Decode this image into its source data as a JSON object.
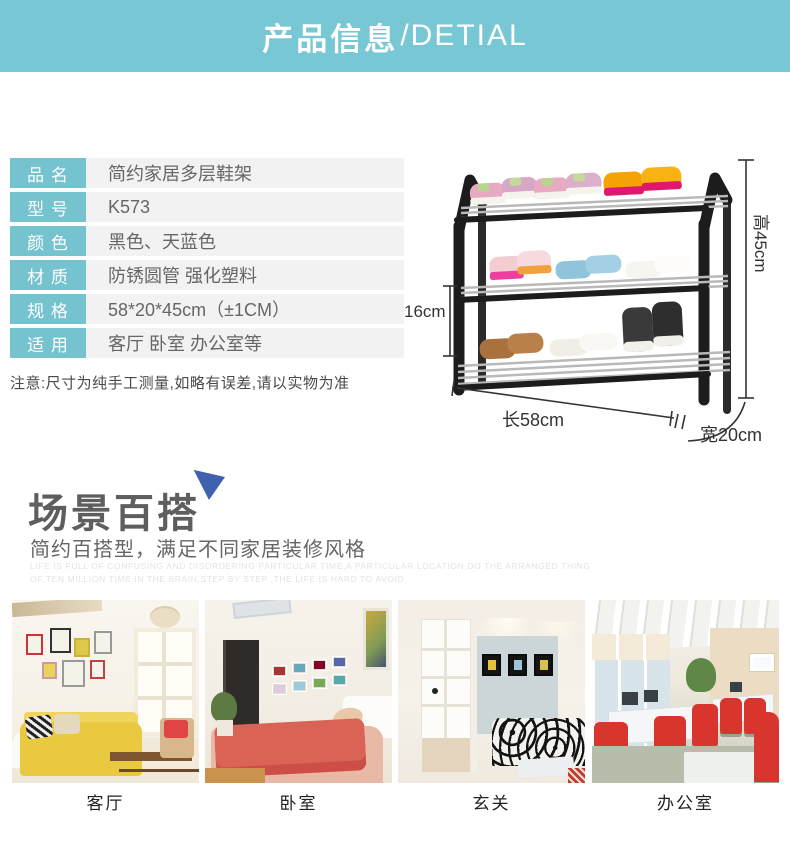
{
  "header": {
    "title_zh": "产品信息",
    "title_en": "/DETIAL"
  },
  "colors": {
    "banner_teal": "#78c7d4",
    "label_teal": "#74c3cf",
    "value_gray": "#f2f2f2",
    "triangle_blue": "#4061ae",
    "frame_black": "#1c1c1c"
  },
  "specs": {
    "rows": [
      {
        "label": "品 名",
        "value": "简约家居多层鞋架"
      },
      {
        "label": "型 号",
        "value": "K573"
      },
      {
        "label": "颜 色",
        "value": "黑色、天蓝色"
      },
      {
        "label": "材 质",
        "value": "防锈圆管 强化塑料"
      },
      {
        "label": "规 格",
        "value": "58*20*45cm（±1CM）"
      },
      {
        "label": "适 用",
        "value": "客厅 卧室 办公室等"
      }
    ],
    "note": "注意:尺寸为纯手工测量,如略有误差,请以实物为准"
  },
  "product": {
    "dimensions": {
      "height": "高45cm",
      "tier": "16cm",
      "length": "长58cm",
      "width": "宽20cm"
    }
  },
  "scene": {
    "title": "场景百搭",
    "subtitle": "简约百搭型，满足不同家居装修风格",
    "watermark_line1": "LIFE IS FULL OF CONFUSING AND DISORDERING PARTICULAR TIME,A PARTICULAR LOCATION,DO THE ARRANGED THING",
    "watermark_line2": "OF TEN MILLION TIME IN THE BRAIN,STEP BY STEP ,THE LIFE IS HARD TO AVOID",
    "scenes": [
      {
        "label": "客厅"
      },
      {
        "label": "卧室"
      },
      {
        "label": "玄关"
      },
      {
        "label": "办公室"
      }
    ]
  }
}
